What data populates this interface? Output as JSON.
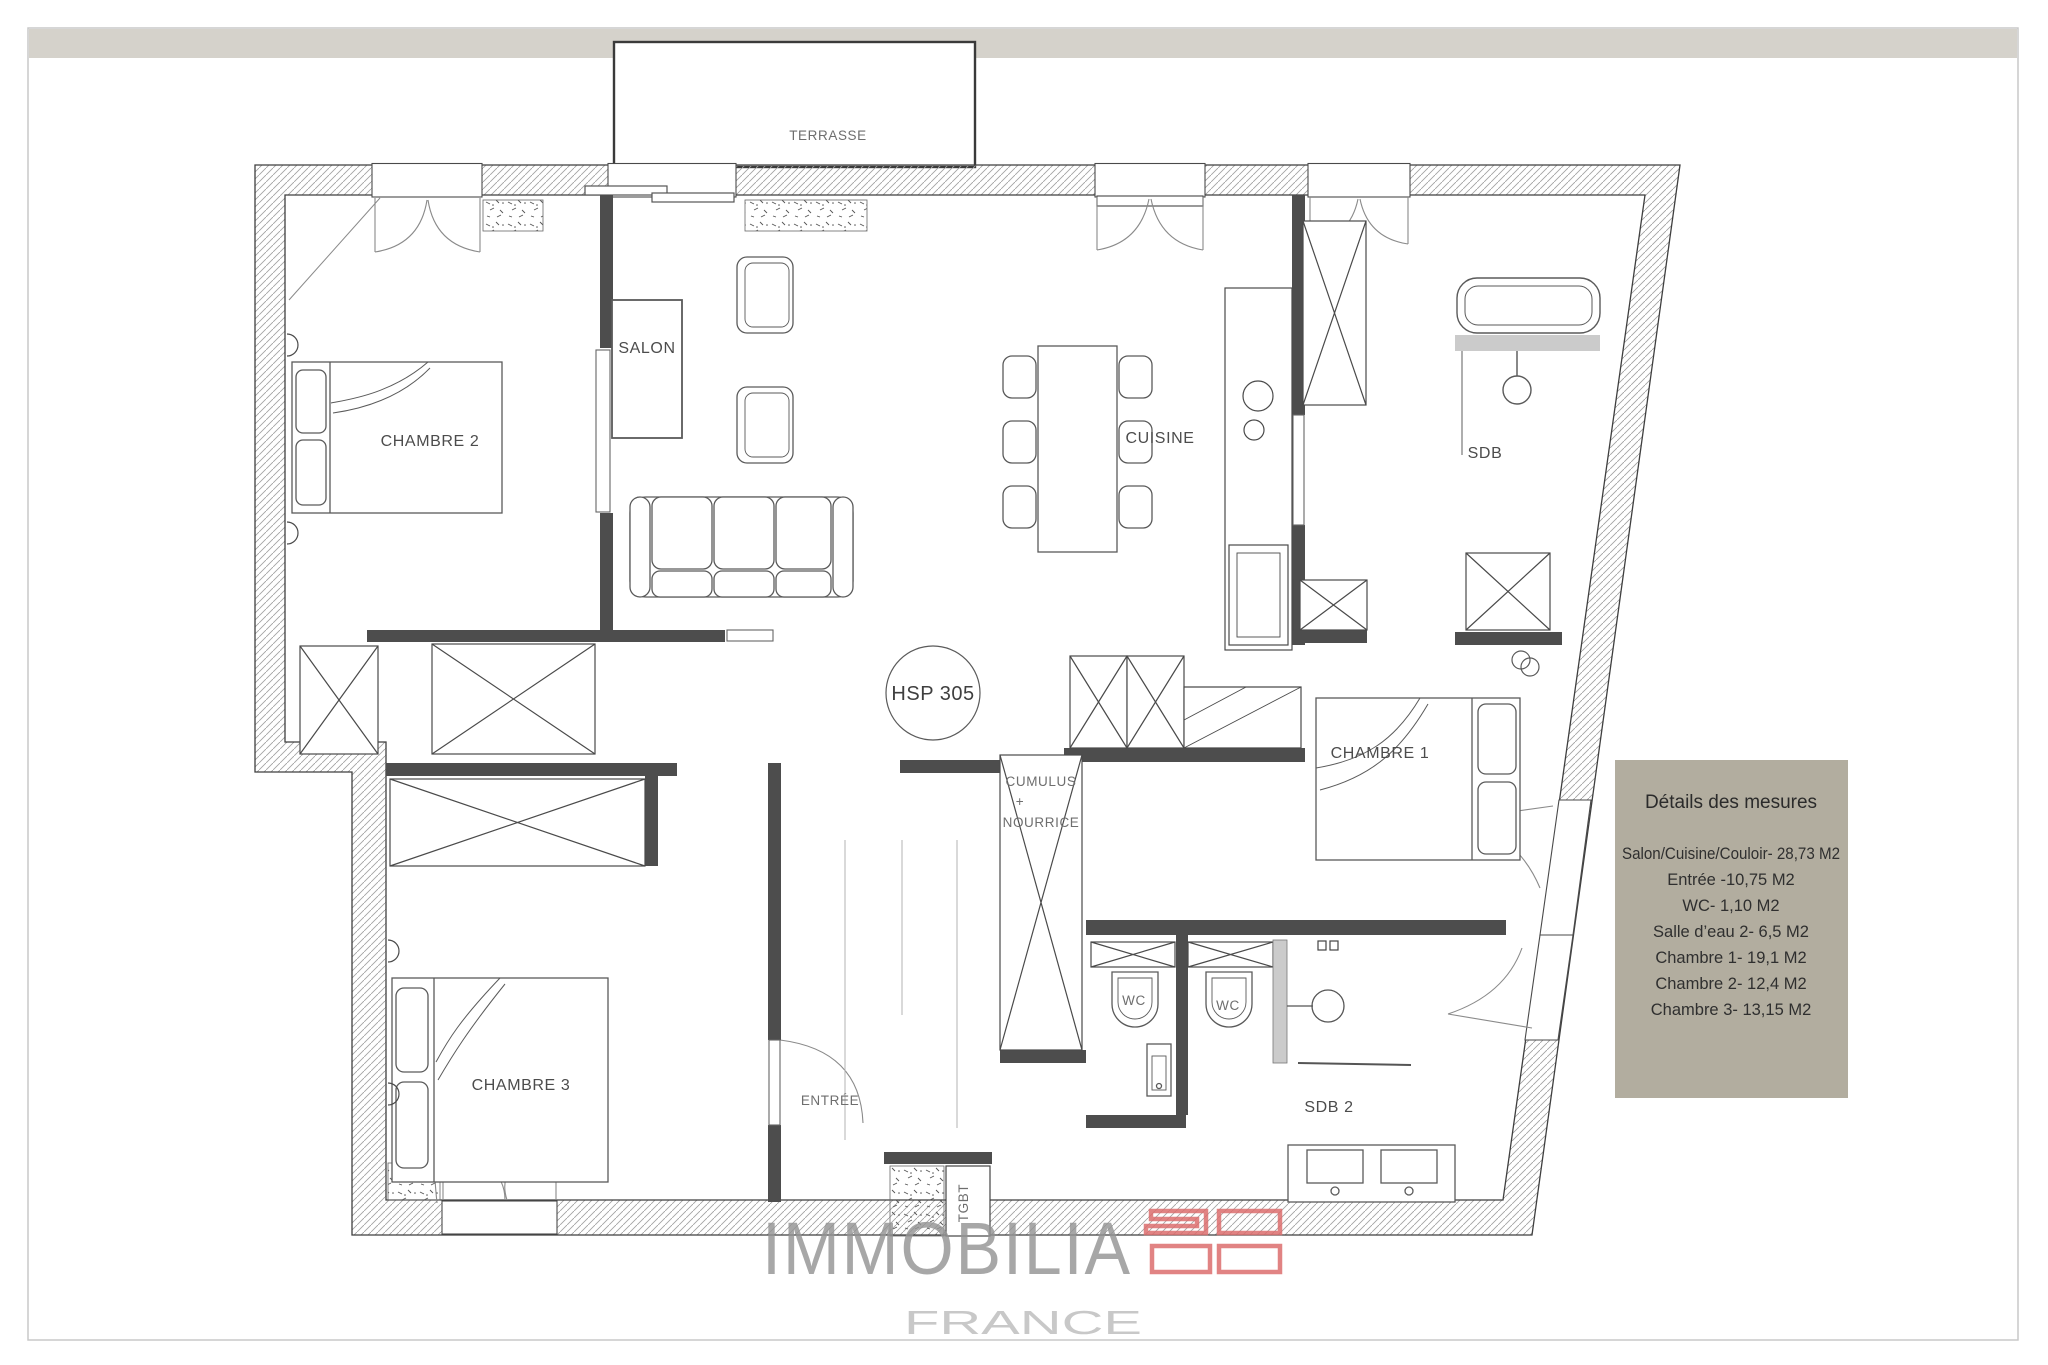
{
  "plan": {
    "labels": {
      "terrasse": "TERRASSE",
      "chambre2": "CHAMBRE 2",
      "salon": "SALON",
      "cuisine": "CUISINE",
      "sdb": "SDB",
      "chambre1": "CHAMBRE 1",
      "chambre3": "CHAMBRE 3",
      "entree": "ENTRÉE",
      "wc1": "WC",
      "wc2": "WC",
      "sdb2": "SDB 2",
      "hsp": "HSP 305",
      "cumulus_line1": "CUMULUS",
      "cumulus_line2": "+",
      "cumulus_line3": "NOURRICE",
      "tgbt": "TGBT"
    }
  },
  "measures_panel": {
    "title": "Détails des mesures",
    "items": [
      "Salon/Cuisine/Couloir- 28,73 M2",
      "Entrée -10,75 M2",
      "WC- 1,10 M2",
      "Salle d’eau 2- 6,5 M2",
      "Chambre 1- 19,1 M2",
      "Chambre 2- 12,4 M2",
      "Chambre 3- 13,15 M2"
    ]
  },
  "logo": {
    "brand": "IMMOBILIA",
    "country": "FRANCE"
  },
  "colors": {
    "top_band": "#d5d2cb",
    "panel_bg": "#b2ad9f",
    "logo_red": "#dc6e6e",
    "brand_gray": "#949494",
    "wall_dark": "#4d4d4d"
  }
}
